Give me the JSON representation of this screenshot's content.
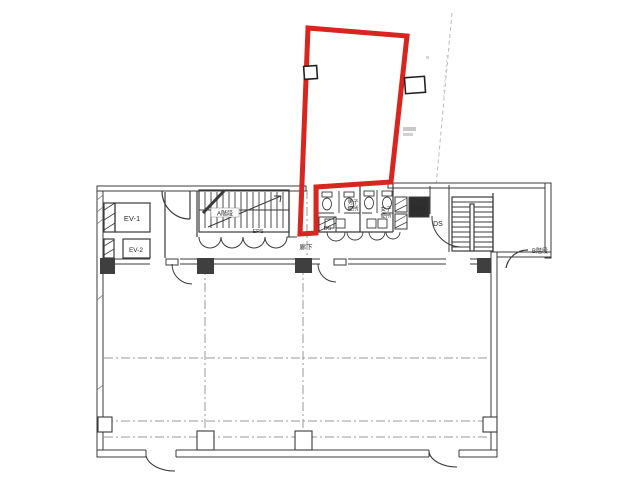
{
  "page": {
    "background": "#ffffff"
  },
  "colors": {
    "unit_outline_red": "#d9251f",
    "wall_line": "#3b3b3b",
    "grid_line": "#9a9a9a",
    "faint_line": "#bdbdbd"
  },
  "plan": {
    "labels": {
      "ev1": "EV-1",
      "ev2": "EV-2",
      "stair_a": "A階段",
      "eps": "EPS",
      "ds_center": "DS",
      "ds_right": "DS",
      "kitchenette": "湯沸室",
      "corridor": "廊下",
      "mens_toilet_line1": "男子",
      "mens_toilet_line2": "便所",
      "womens_toilet_line1": "女子",
      "womens_toilet_line2": "便所",
      "stair_b": "B階段"
    }
  }
}
